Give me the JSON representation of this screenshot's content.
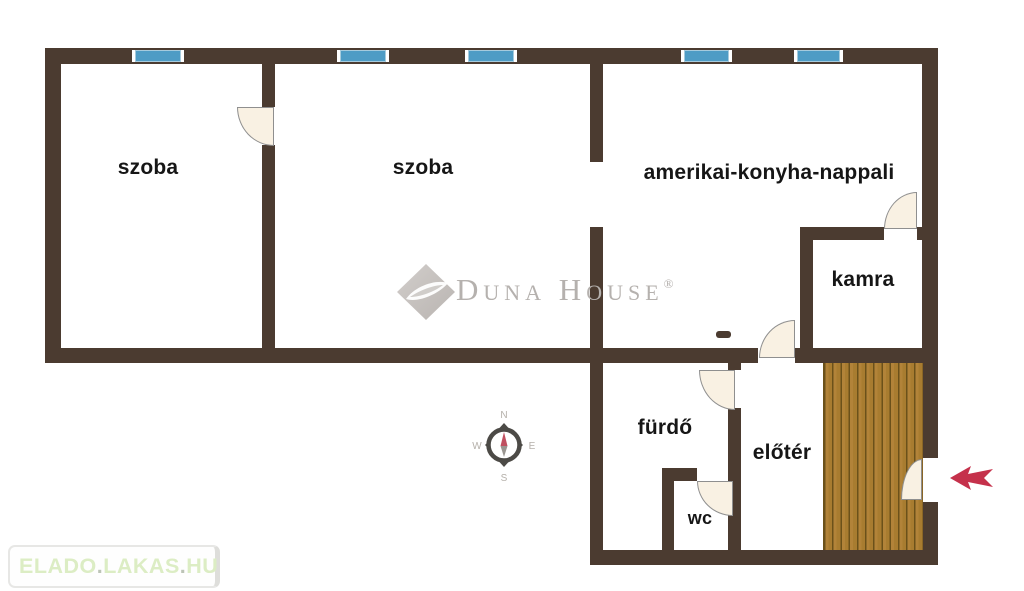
{
  "plan": {
    "rooms": {
      "szoba1": {
        "label": "szoba"
      },
      "szoba2": {
        "label": "szoba"
      },
      "living": {
        "label": "amerikai-konyha-nappali"
      },
      "kamra": {
        "label": "kamra"
      },
      "furdo": {
        "label": "fürdő"
      },
      "eloter": {
        "label": "előtér"
      },
      "wc": {
        "label": "wc"
      }
    },
    "window_count": 5,
    "entrance_marker": "red-arrow-pointing-left-at-entrance-door"
  },
  "compass": {
    "n": "N",
    "e": "E",
    "s": "S",
    "w": "W"
  },
  "watermark": {
    "brand": "Duna House",
    "reg": "®"
  },
  "footer_logo": {
    "part1": "ELADO",
    "dot1": ".",
    "part2": "LAKAS",
    "dot2": ".",
    "part3": "HU"
  },
  "colors": {
    "wall": "#4b3b30",
    "window_blue": "#4e9cc5",
    "door_cream": "#f9f1e3",
    "wood_floor": "#a87c30",
    "arrow_red": "#c5314b",
    "logo_green": "#dcedc4",
    "watermark_gray": "#b5b1ae"
  }
}
